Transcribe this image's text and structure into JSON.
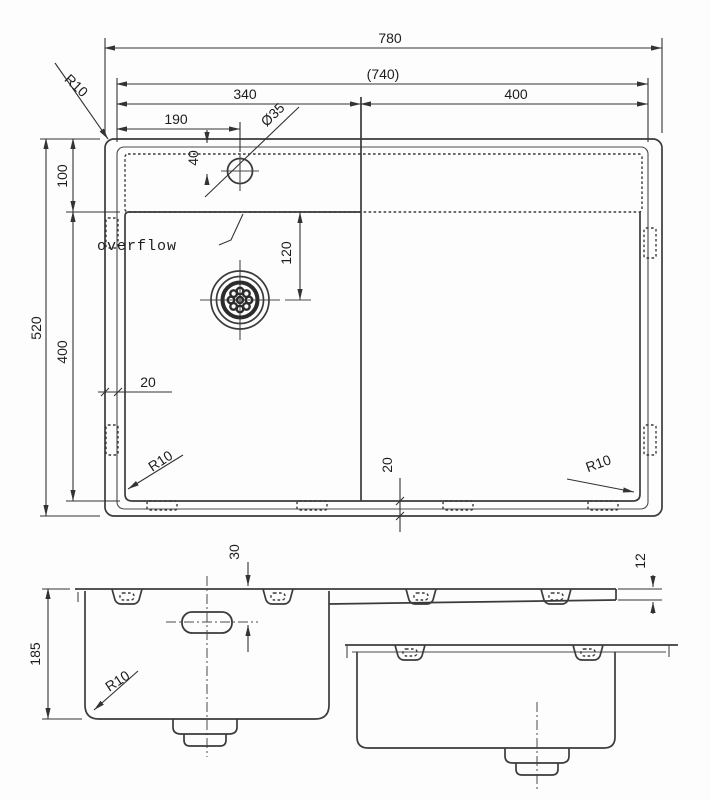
{
  "drawing": {
    "top_view": {
      "width_overall": "780",
      "width_inner": "(740)",
      "width_left_bowl": "340",
      "width_right_section": "400",
      "faucet_hole_offset": "190",
      "faucet_hole_diameter": "Ø35",
      "faucet_hole_from_top": "40",
      "overflow_zone_height": "100",
      "height_overall": "520",
      "bowl_depth_front": "400",
      "drain_center_offset": "120",
      "rim_width_left": "20",
      "rim_width_bottom": "20",
      "radius_top_left": "R10",
      "radius_bottom_left": "R10",
      "radius_bottom_right": "R10",
      "overflow_label": "overflow"
    },
    "section_view": {
      "bowl_height": "185",
      "overflow_hole_from_rim": "30",
      "bowl_corner_radius": "R10",
      "drainboard_drop": "12"
    },
    "colors": {
      "line": "#3b3b3b",
      "background": "#fdfdfd",
      "text": "#1d1d1d"
    }
  }
}
